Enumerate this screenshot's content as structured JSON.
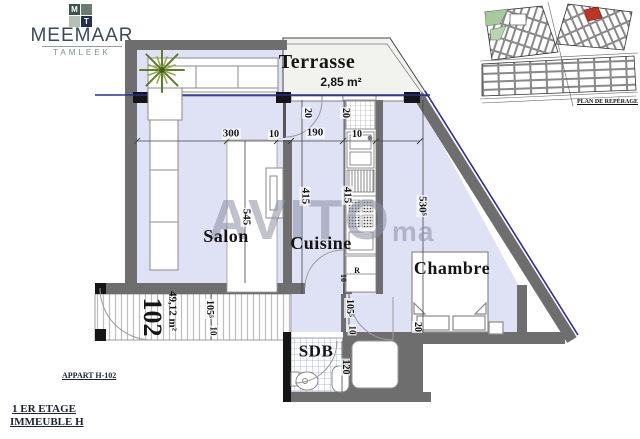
{
  "branding": {
    "name": "MEEMAAR",
    "subtitle": "TAMLEEK",
    "monogram": {
      "m": "M",
      "t": "T"
    }
  },
  "site_plan": {
    "caption": "PLAN DE REPÉRAGE"
  },
  "watermark": {
    "text": "AVITO",
    "suffix": "ma"
  },
  "rooms": {
    "terrasse": "Terrasse",
    "terrasse_area": "2,85 m²",
    "salon": "Salon",
    "cuisine": "Cuisine",
    "chambre": "Chambre",
    "sdb": "SDB"
  },
  "unit": {
    "number": "102",
    "area": "49,12 m²",
    "fridge": "R"
  },
  "dims": {
    "d300": "300",
    "d10a": "10",
    "d190": "190",
    "d10b": "10",
    "d545": "545",
    "d20a": "20",
    "d20b": "20",
    "d415a": "415",
    "d415b": "415",
    "d530": "530⁵",
    "d105a": "105⁵",
    "d10c": "10",
    "d105b": "105⁵",
    "d10d": "10",
    "d20c": "20",
    "d120": "120",
    "d10e": "10"
  },
  "footer": {
    "apartment": "APPART H-102",
    "floor": "1 ER ETAGE",
    "building": "IMMEUBLE H"
  },
  "colors": {
    "floor": "#dfe1f5",
    "wall": "#6e6e6e",
    "accent_blue": "#2b2b9b",
    "terrace": "#f2f2ef",
    "highlight_red": "#c23327",
    "green": "#a8c8a0"
  }
}
